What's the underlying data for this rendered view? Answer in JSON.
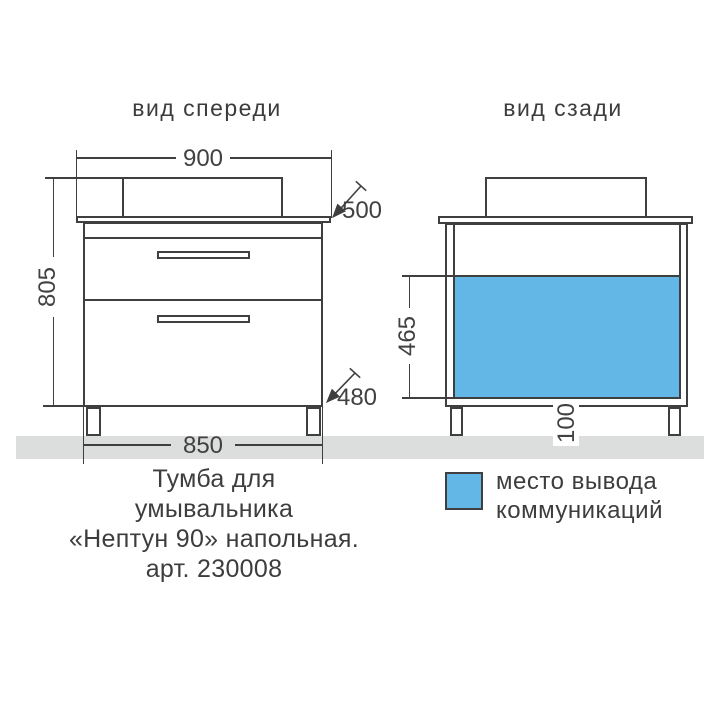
{
  "front_view": {
    "title": "вид спереди",
    "dimensions": {
      "top_width": "900",
      "countertop_depth": "500",
      "total_height": "805",
      "cabinet_depth": "480",
      "cabinet_width": "850"
    }
  },
  "back_view": {
    "title": "вид сзади",
    "dimensions": {
      "communications_height": "465",
      "communications_offset": "100"
    }
  },
  "legend": {
    "swatch_color": "#62b7e6",
    "label_line1": "место вывода",
    "label_line2": "коммуникаций"
  },
  "caption": {
    "line1": "Тумба для",
    "line2": "умывальника",
    "line3": "«Нептун 90» напольная.",
    "line4": "арт. 230008"
  },
  "colors": {
    "communications_fill": "#62b7e6",
    "floor_strip": "#dcdddd",
    "outline": "#3f3f3f",
    "text": "#414141"
  }
}
